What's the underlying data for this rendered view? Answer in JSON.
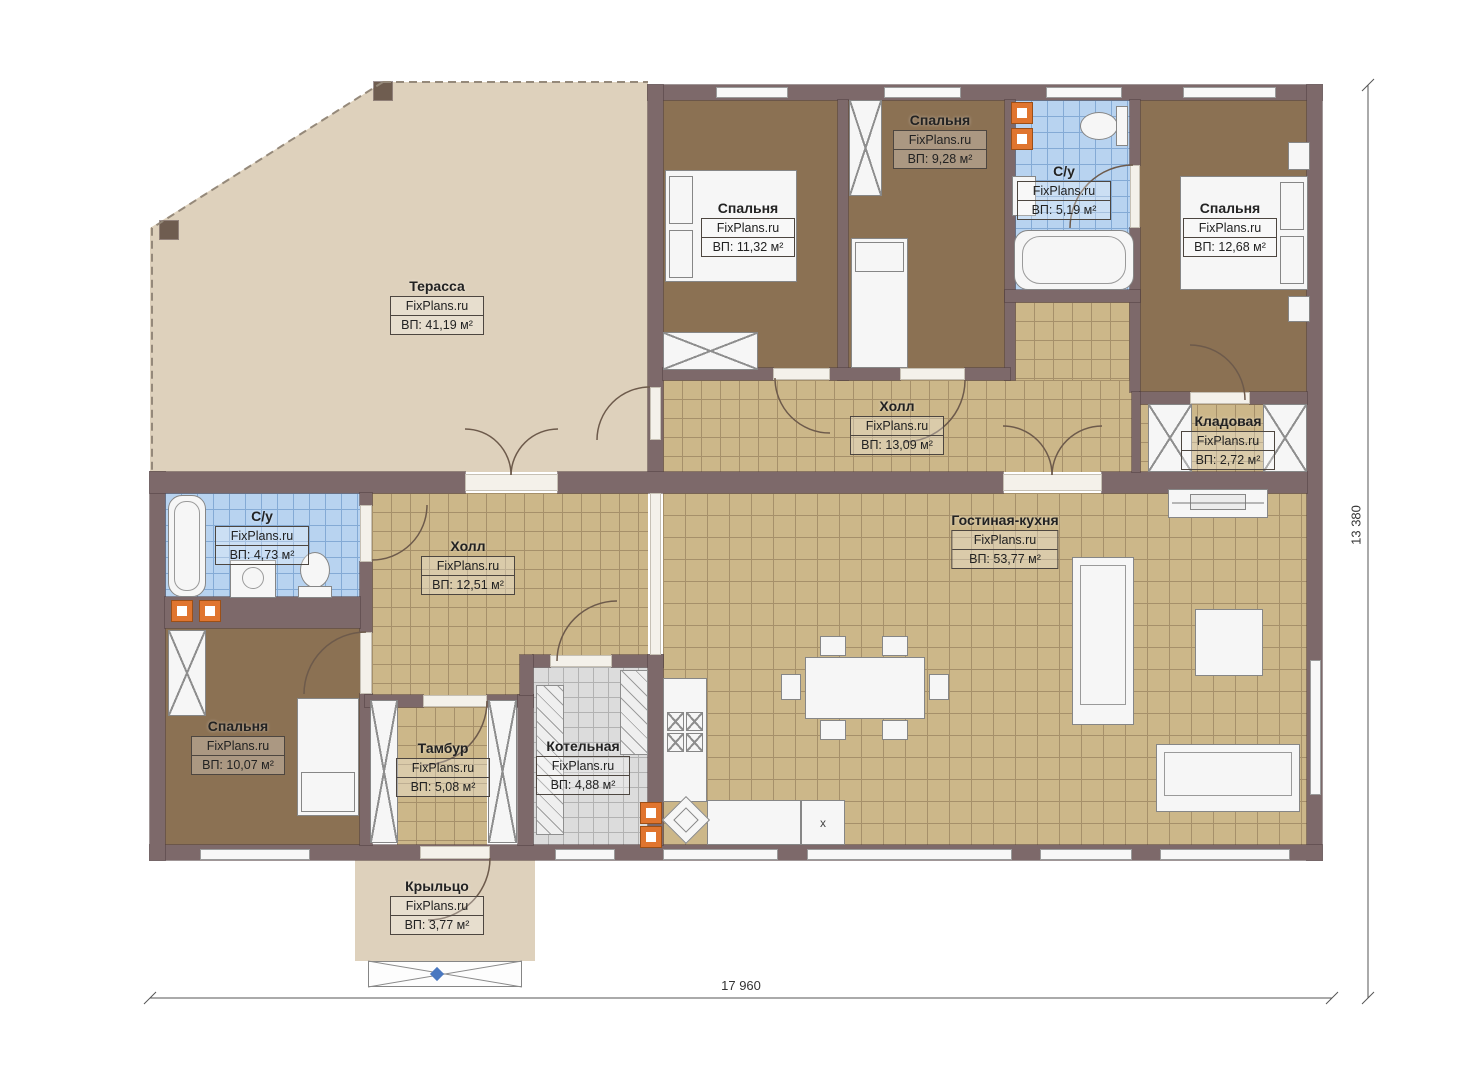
{
  "brand": "FixPlans.ru",
  "rooms": {
    "terrace": {
      "name": "Терасса",
      "area": "ВП: 41,19 м²"
    },
    "bedroom1": {
      "name": "Спальня",
      "area": "ВП: 11,32 м²"
    },
    "bedroom2": {
      "name": "Спальня",
      "area": "ВП: 9,28 м²"
    },
    "bathroom_top": {
      "name": "С/у",
      "area": "ВП: 5,19 м²"
    },
    "bedroom3": {
      "name": "Спальня",
      "area": "ВП: 12,68 м²"
    },
    "hall_top": {
      "name": "Холл",
      "area": "ВП: 13,09 м²"
    },
    "storage": {
      "name": "Кладовая",
      "area": "ВП: 2,72 м²"
    },
    "living": {
      "name": "Гостиная-кухня",
      "area": "ВП: 53,77 м²"
    },
    "bathroom_bottom": {
      "name": "С/у",
      "area": "ВП: 4,73 м²"
    },
    "hall_bottom": {
      "name": "Холл",
      "area": "ВП: 12,51 м²"
    },
    "bedroom4": {
      "name": "Спальня",
      "area": "ВП: 10,07 м²"
    },
    "vestibule": {
      "name": "Тамбур",
      "area": "ВП: 5,08 м²"
    },
    "boiler": {
      "name": "Котельная",
      "area": "ВП: 4,88 м²"
    },
    "porch": {
      "name": "Крыльцо",
      "area": "ВП: 3,77 м²"
    }
  },
  "dimensions": {
    "width_label": "17 960",
    "height_label": "13 380"
  },
  "annotations": {
    "stove_mark": "х"
  },
  "colors": {
    "wall": "#7d696a",
    "bedroom_floor": "#8b7153",
    "tile_tan": "#ccb789",
    "tile_blue": "#b8d3f0",
    "tile_gray": "#dcdcdc",
    "terrace": "#ded1bc",
    "accent_orange": "#e0752f",
    "marker_blue": "#4a78c0"
  }
}
